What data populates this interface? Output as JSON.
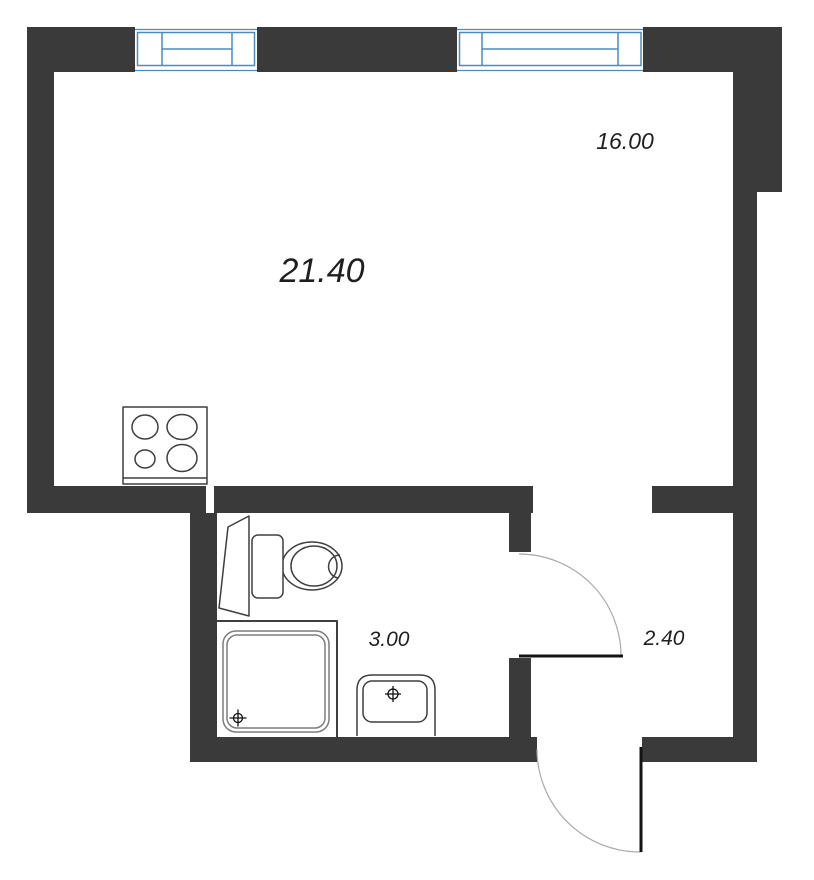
{
  "plan": {
    "title": "studio apartment floor plan",
    "labels": {
      "living_area": "21.40",
      "room_area": "16.00",
      "bathroom_area": "3.00",
      "hall_area": "2.40"
    },
    "symbols": [
      "window",
      "stove-cooktop",
      "toilet",
      "shower-tray",
      "sink",
      "door-swing"
    ],
    "colors": {
      "wall": "#3a3a3a",
      "paper": "#ffffff",
      "window": "#4a8cc0",
      "fixture_outline": "#3f3f3f",
      "tray_outline": "#7d7d7d",
      "symbol": "#111111",
      "door_leaf": "#141414",
      "door_arc": "#aaaaaa",
      "text": "#1f1f1f"
    }
  }
}
